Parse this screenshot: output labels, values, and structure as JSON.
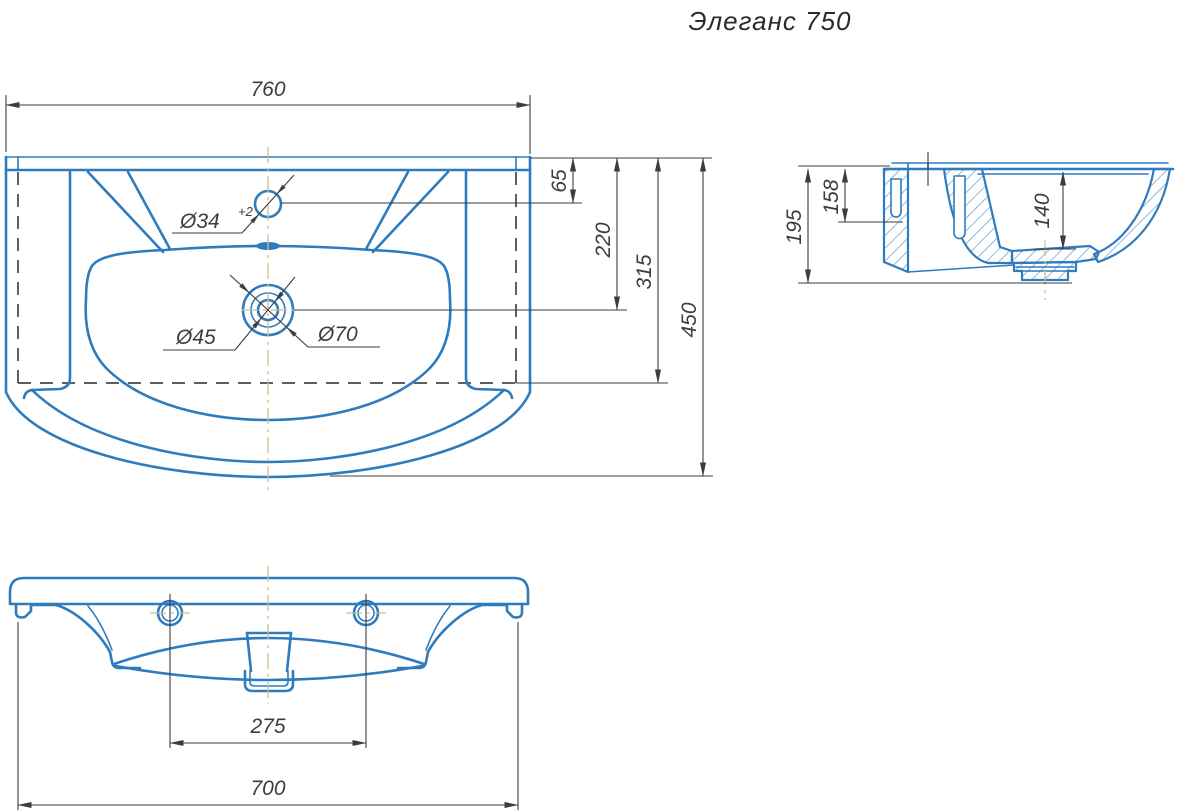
{
  "title": "Элеганс 750",
  "top_view": {
    "dim_width": "760",
    "dim_rim_to_faucet": "65",
    "dim_rim_to_drain": "220",
    "dim_rim_to_cabinet_front": "315",
    "dim_depth": "450",
    "faucet_hole_dia": "Ø34",
    "faucet_hole_tolerance": "+2",
    "drain_dia_inner": "Ø45",
    "drain_dia_outer": "Ø70"
  },
  "side_view": {
    "dim_height": "195",
    "dim_mount_slot": "158",
    "dim_bowl_depth": "140"
  },
  "front_view": {
    "dim_hole_spacing": "275",
    "dim_mount_width": "700"
  },
  "colors": {
    "line_blue": "#2e7bbd",
    "line_blue_light": "#5b9bd5",
    "dim_gray": "#3d3d3d",
    "dashed_dark": "#3f4850",
    "centerline_tan": "#cdbf8e"
  }
}
